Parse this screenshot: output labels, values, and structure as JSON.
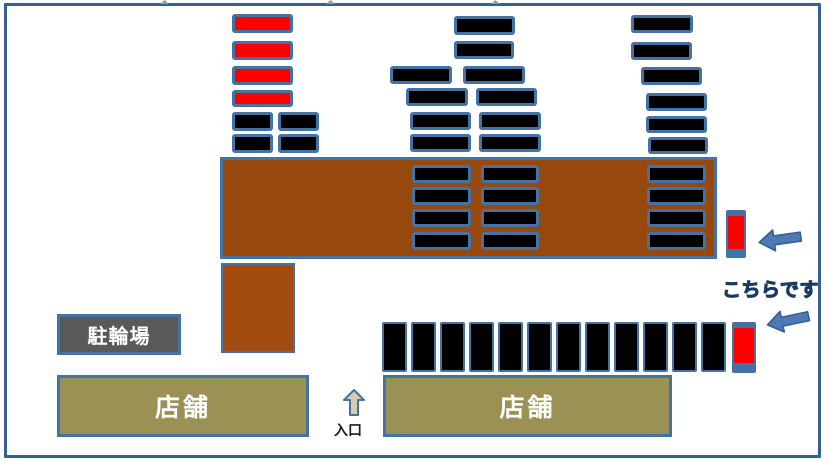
{
  "page": {
    "width": 828,
    "height": 467,
    "background": "#ffffff"
  },
  "colors": {
    "page_border": "#36618e",
    "space_border": "#4472a4",
    "black": "#000000",
    "red": "#fe0000",
    "lot_brown": "#97480c",
    "lot_brown_small": "#a24c12",
    "facility_gray": "#595959",
    "shop_olive": "#9b9155",
    "facility_border": "#4472a4",
    "arrow_fill": "#4d79b4",
    "arrow_stroke": "#365f91",
    "entrance_arrow_fill": "#d6cea6",
    "entrance_arrow_stroke": "#4472a4",
    "here_text_fill": "#4a86c8",
    "here_text_stroke": "#1b3a63",
    "label_white": "#ffffff",
    "entrance_label": "#1a1a1a",
    "top_mark_gray": "#9b9b9b"
  },
  "labels": {
    "bicycle_parking": "駐輪場",
    "shop_left": "店舗",
    "shop_right": "店舗",
    "entrance": "入口",
    "here": "こちらです"
  },
  "parking_spaces": {
    "horizontal": [
      {
        "x": 232,
        "y": 14,
        "w": 61,
        "h": 19,
        "color": "red"
      },
      {
        "x": 232,
        "y": 41,
        "w": 61,
        "h": 19,
        "color": "red"
      },
      {
        "x": 232,
        "y": 66,
        "w": 61,
        "h": 19,
        "color": "red"
      },
      {
        "x": 232,
        "y": 90,
        "w": 61,
        "h": 17,
        "color": "red"
      },
      {
        "x": 232,
        "y": 112,
        "w": 41,
        "h": 19,
        "color": "black"
      },
      {
        "x": 278,
        "y": 112,
        "w": 41,
        "h": 19,
        "color": "black"
      },
      {
        "x": 232,
        "y": 134,
        "w": 41,
        "h": 19,
        "color": "black"
      },
      {
        "x": 278,
        "y": 134,
        "w": 41,
        "h": 19,
        "color": "black"
      },
      {
        "x": 454,
        "y": 16,
        "w": 61,
        "h": 19,
        "color": "black"
      },
      {
        "x": 454,
        "y": 41,
        "w": 60,
        "h": 18,
        "color": "black"
      },
      {
        "x": 390,
        "y": 66,
        "w": 62,
        "h": 18,
        "color": "black"
      },
      {
        "x": 463,
        "y": 66,
        "w": 62,
        "h": 18,
        "color": "black"
      },
      {
        "x": 406,
        "y": 88,
        "w": 62,
        "h": 18,
        "color": "black"
      },
      {
        "x": 476,
        "y": 88,
        "w": 61,
        "h": 18,
        "color": "black"
      },
      {
        "x": 410,
        "y": 112,
        "w": 61,
        "h": 18,
        "color": "black"
      },
      {
        "x": 479,
        "y": 112,
        "w": 62,
        "h": 18,
        "color": "black"
      },
      {
        "x": 410,
        "y": 134,
        "w": 61,
        "h": 18,
        "color": "black"
      },
      {
        "x": 479,
        "y": 134,
        "w": 62,
        "h": 18,
        "color": "black"
      },
      {
        "x": 631,
        "y": 15,
        "w": 62,
        "h": 18,
        "color": "black"
      },
      {
        "x": 631,
        "y": 42,
        "w": 61,
        "h": 18,
        "color": "black"
      },
      {
        "x": 641,
        "y": 67,
        "w": 61,
        "h": 18,
        "color": "black"
      },
      {
        "x": 646,
        "y": 93,
        "w": 61,
        "h": 18,
        "color": "black"
      },
      {
        "x": 646,
        "y": 116,
        "w": 61,
        "h": 17,
        "color": "black"
      },
      {
        "x": 648,
        "y": 137,
        "w": 60,
        "h": 17,
        "color": "black"
      },
      {
        "x": 412,
        "y": 165,
        "w": 59,
        "h": 18,
        "color": "black"
      },
      {
        "x": 481,
        "y": 165,
        "w": 58,
        "h": 18,
        "color": "black"
      },
      {
        "x": 647,
        "y": 165,
        "w": 59,
        "h": 18,
        "color": "black"
      },
      {
        "x": 412,
        "y": 187,
        "w": 59,
        "h": 18,
        "color": "black"
      },
      {
        "x": 481,
        "y": 187,
        "w": 58,
        "h": 18,
        "color": "black"
      },
      {
        "x": 647,
        "y": 187,
        "w": 59,
        "h": 18,
        "color": "black"
      },
      {
        "x": 412,
        "y": 209,
        "w": 59,
        "h": 18,
        "color": "black"
      },
      {
        "x": 481,
        "y": 209,
        "w": 58,
        "h": 18,
        "color": "black"
      },
      {
        "x": 647,
        "y": 209,
        "w": 59,
        "h": 18,
        "color": "black"
      },
      {
        "x": 412,
        "y": 232,
        "w": 59,
        "h": 18,
        "color": "black"
      },
      {
        "x": 481,
        "y": 232,
        "w": 58,
        "h": 18,
        "color": "black"
      },
      {
        "x": 647,
        "y": 232,
        "w": 59,
        "h": 18,
        "color": "black"
      }
    ],
    "vertical_black": [
      {
        "x": 382,
        "y": 322,
        "w": 25,
        "h": 50,
        "color": "black"
      },
      {
        "x": 411,
        "y": 322,
        "w": 25,
        "h": 50,
        "color": "black"
      },
      {
        "x": 440,
        "y": 322,
        "w": 25,
        "h": 50,
        "color": "black"
      },
      {
        "x": 469,
        "y": 322,
        "w": 25,
        "h": 50,
        "color": "black"
      },
      {
        "x": 498,
        "y": 322,
        "w": 25,
        "h": 50,
        "color": "black"
      },
      {
        "x": 527,
        "y": 322,
        "w": 25,
        "h": 50,
        "color": "black"
      },
      {
        "x": 556,
        "y": 322,
        "w": 25,
        "h": 50,
        "color": "black"
      },
      {
        "x": 585,
        "y": 322,
        "w": 25,
        "h": 50,
        "color": "black"
      },
      {
        "x": 614,
        "y": 322,
        "w": 25,
        "h": 50,
        "color": "black"
      },
      {
        "x": 643,
        "y": 322,
        "w": 25,
        "h": 50,
        "color": "black"
      },
      {
        "x": 672,
        "y": 322,
        "w": 25,
        "h": 50,
        "color": "black"
      },
      {
        "x": 701,
        "y": 322,
        "w": 25,
        "h": 50,
        "color": "black"
      }
    ],
    "highlighted_red": [
      {
        "x": 726,
        "y": 210,
        "w": 20,
        "h": 48,
        "color": "red",
        "cap_top": 6,
        "cap_bottom": 9
      },
      {
        "x": 732,
        "y": 322,
        "w": 24,
        "h": 51,
        "color": "red",
        "cap_top": 6,
        "cap_bottom": 10
      }
    ]
  },
  "top_marks": [
    {
      "x": 160
    },
    {
      "x": 326
    },
    {
      "x": 491
    }
  ]
}
